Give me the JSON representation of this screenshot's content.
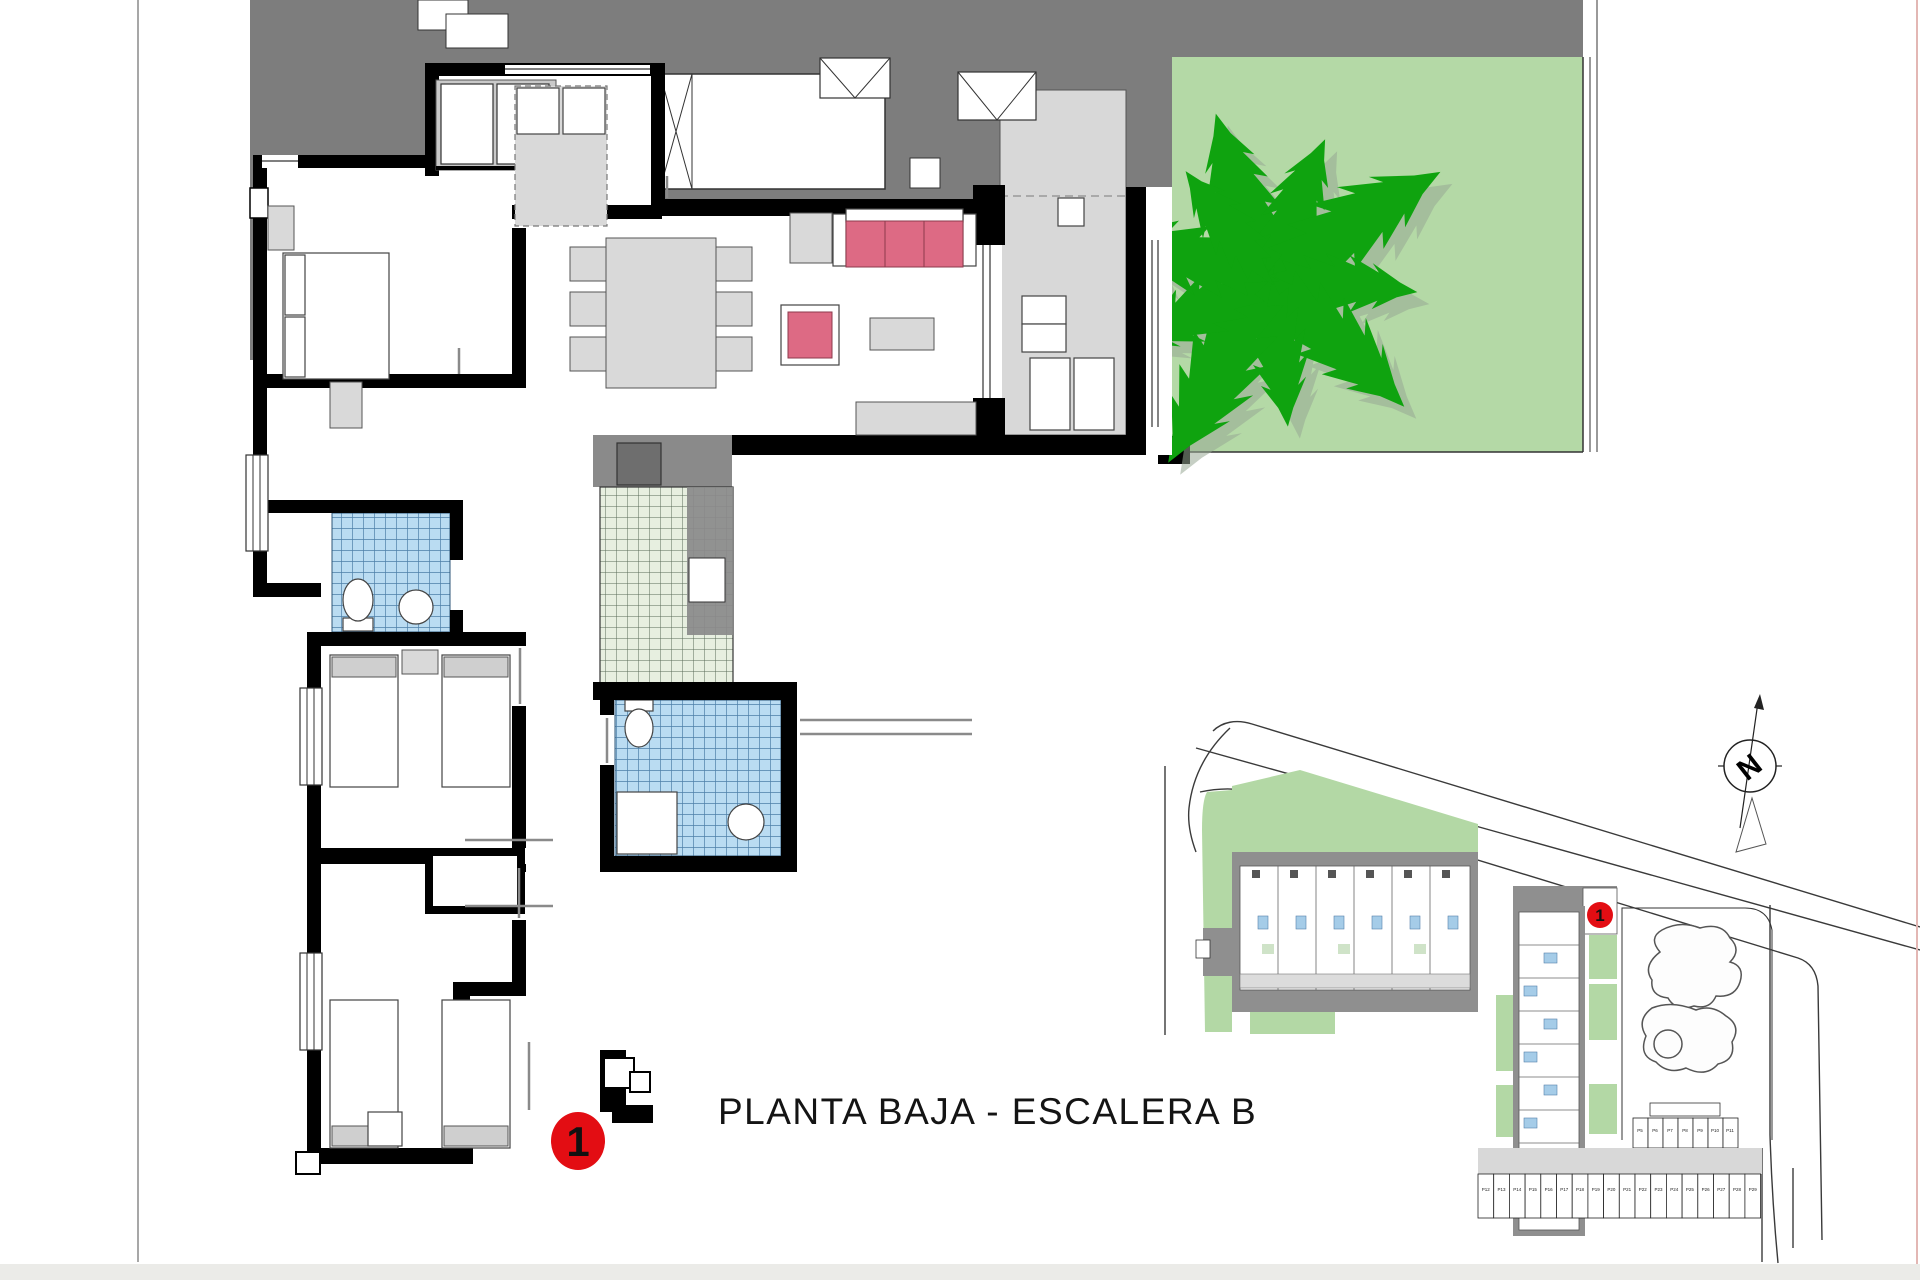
{
  "title": {
    "text": "PLANTA BAJA - ESCALERA B"
  },
  "markers": {
    "plan_unit": "1",
    "site_unit": "1"
  },
  "compass": {
    "label": "N"
  },
  "colors": {
    "wall_black": "#000000",
    "terrace_dark_gray": "#7d7d7d",
    "terrace_floor_gray": "#d8d8d8",
    "furniture_gray": "#d9d9d9",
    "garden_green": "#b4d9a6",
    "tree_green": "#0fa30f",
    "tree_shadow_gray": "#98a894",
    "bath_tile_blue": "#badcf2",
    "bath_tile_grid": "#4d7fa8",
    "kitchen_tile_green": "#e7efe0",
    "kitchen_counter_gray": "#8a8a8a",
    "sofa_pink": "#dd6a84",
    "marker_red": "#e30d13",
    "site_building_gray": "#8f8f8f",
    "site_pool_outline": "#555555"
  },
  "site_plan": {
    "parking_upper": {
      "labels": [
        "P5",
        "P6",
        "P7",
        "P8",
        "P9",
        "P10",
        "P11"
      ]
    },
    "parking_lower": {
      "labels": [
        "P12",
        "P13",
        "P14",
        "P15",
        "P16",
        "P17",
        "P18",
        "P19",
        "P20",
        "P21",
        "P22",
        "P23",
        "P24",
        "P25",
        "P26",
        "P27",
        "P28",
        "P29"
      ]
    }
  }
}
